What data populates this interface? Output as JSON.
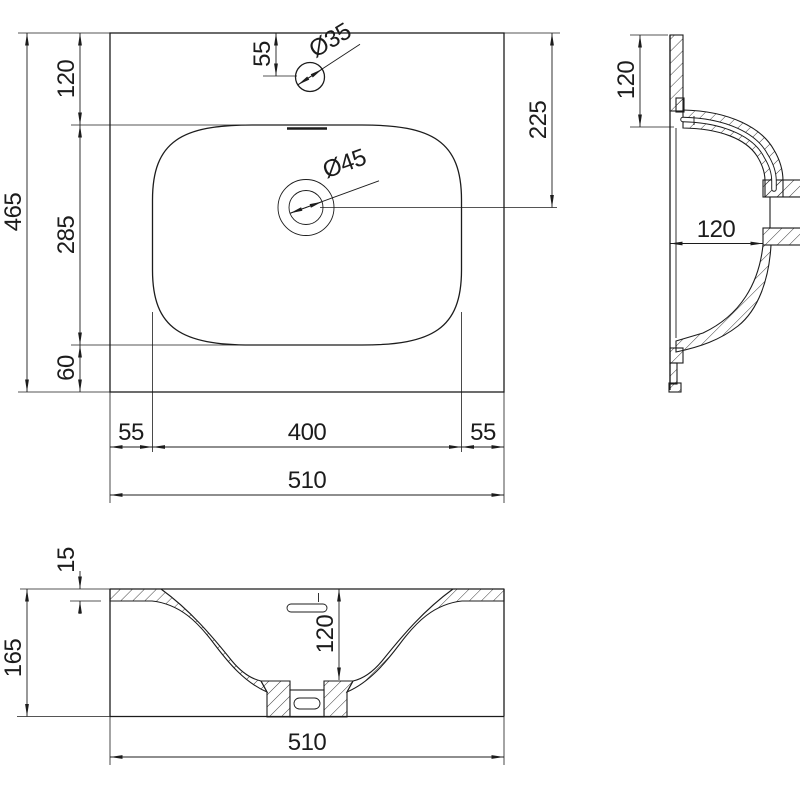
{
  "drawing": {
    "type": "washbasin-technical-drawing",
    "views": {
      "plan": {
        "dims": {
          "overall_depth": "465",
          "back_margin": "120",
          "basin_depth": "285",
          "front_margin": "60",
          "faucet_offset": "55",
          "faucet_hole_diameter": "Ø35",
          "drain_hole_diameter": "Ø45",
          "drain_from_back": "225",
          "left_margin": "55",
          "basin_width": "400",
          "right_margin": "55",
          "overall_width": "510"
        }
      },
      "side_section": {
        "dims": {
          "back_offset": "120",
          "bowl_depth": "120"
        }
      },
      "front_section": {
        "dims": {
          "rim_thickness": "15",
          "overall_height": "165",
          "bowl_depth": "120",
          "overall_width": "510"
        }
      }
    }
  }
}
